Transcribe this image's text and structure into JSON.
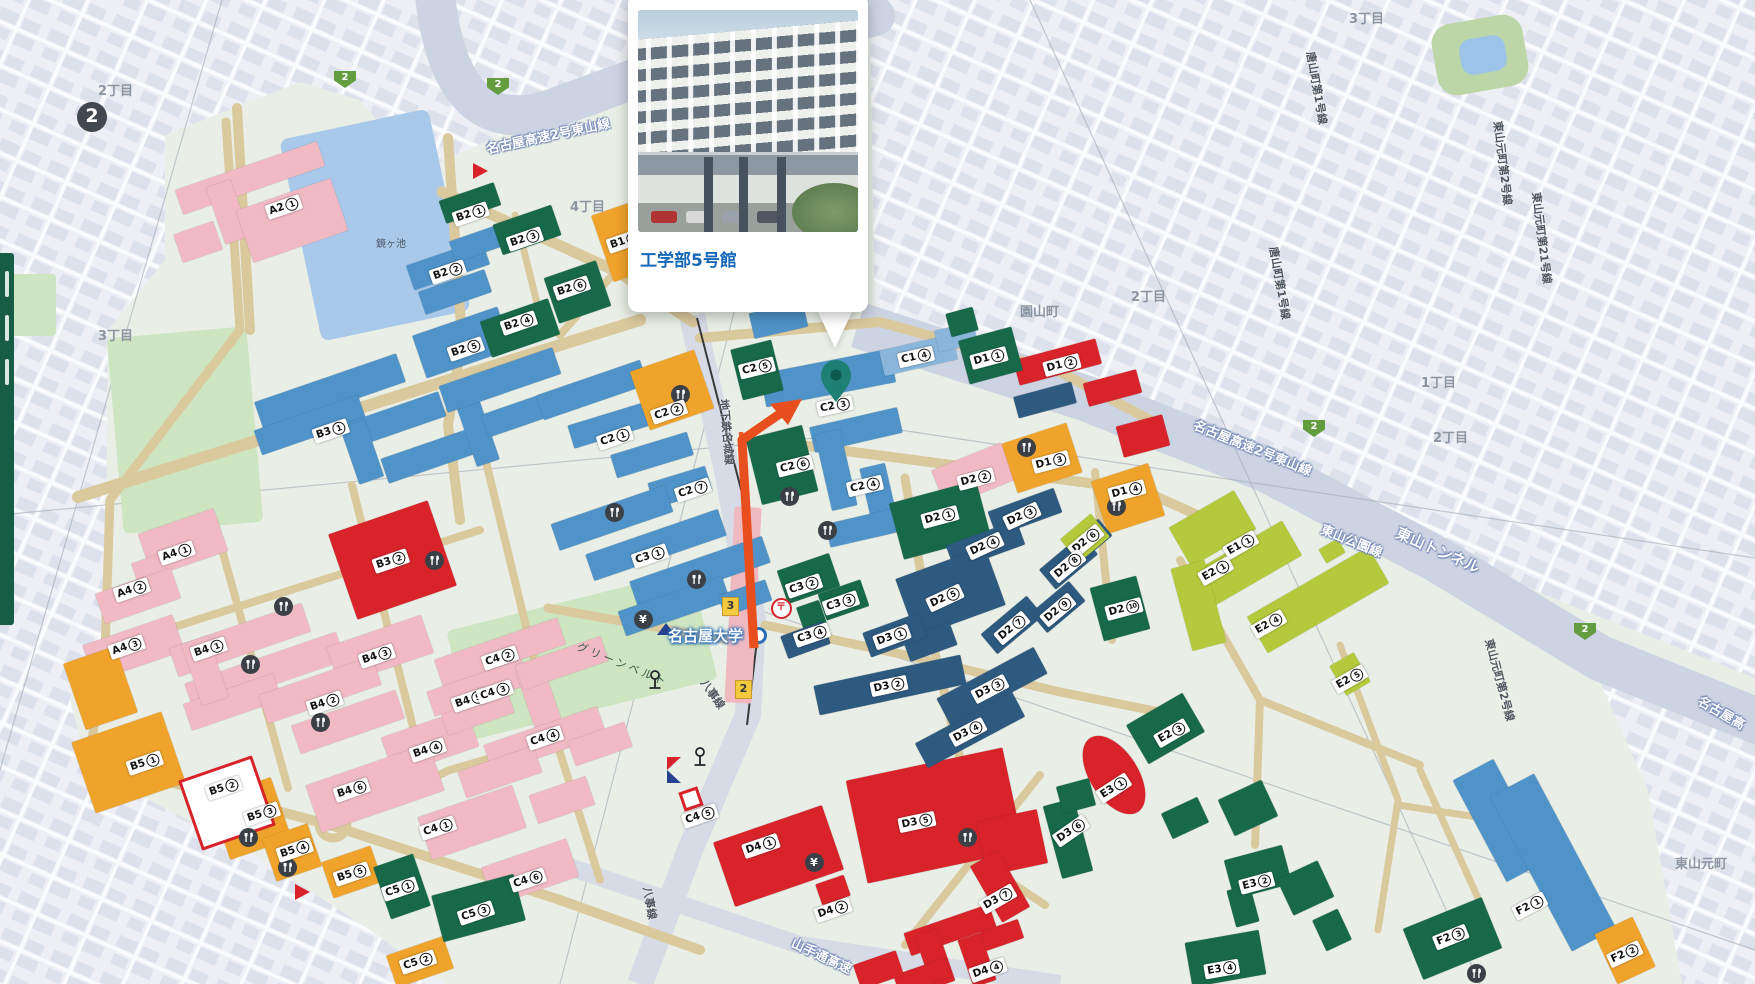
{
  "popup": {
    "title": "工学部5号館"
  },
  "colors": {
    "campus": "#e9efe6",
    "offcampus": "#edeff4",
    "offblock": "#dde1ec",
    "road_campus": "#dbc99e",
    "highway": "#ccd3e2",
    "pond": "#a9c9ea",
    "field": "#cde5c0",
    "blue": "#4f93c8",
    "lightblue": "#8ab6dc",
    "pink": "#f0b9c4",
    "red": "#d8232b",
    "orange": "#f0a32a",
    "green": "#17694a",
    "navy": "#2e5a80",
    "lime": "#b5c93c",
    "pin": "#1e7f74",
    "pin_dark": "#0c584f",
    "arrow": "#e84e1e",
    "title_blue": "#1668b8",
    "subway_orange": "#f15c2c",
    "station_pink": "#f0b9c0"
  },
  "map": {
    "station": {
      "name": "名古屋大学"
    },
    "building_labels": [
      {
        "t": "A2",
        "n": "1",
        "x": 284,
        "y": 207
      },
      {
        "t": "A4",
        "n": "1",
        "x": 177,
        "y": 553
      },
      {
        "t": "A4",
        "n": "2",
        "x": 132,
        "y": 590
      },
      {
        "t": "A4",
        "n": "3",
        "x": 127,
        "y": 647
      },
      {
        "t": "B1",
        "n": "1",
        "x": 625,
        "y": 241
      },
      {
        "t": "B2",
        "n": "1",
        "x": 471,
        "y": 214
      },
      {
        "t": "B2",
        "n": "2",
        "x": 448,
        "y": 272
      },
      {
        "t": "B2",
        "n": "3",
        "x": 525,
        "y": 239
      },
      {
        "t": "B2",
        "n": "4",
        "x": 519,
        "y": 323
      },
      {
        "t": "B2",
        "n": "5",
        "x": 466,
        "y": 349
      },
      {
        "t": "B2",
        "n": "6",
        "x": 572,
        "y": 288
      },
      {
        "t": "B3",
        "n": "1",
        "x": 331,
        "y": 431
      },
      {
        "t": "B3",
        "n": "2",
        "x": 391,
        "y": 561
      },
      {
        "t": "B4",
        "n": "1",
        "x": 209,
        "y": 649
      },
      {
        "t": "B4",
        "n": "2",
        "x": 325,
        "y": 703
      },
      {
        "t": "B4",
        "n": "3",
        "x": 377,
        "y": 656
      },
      {
        "t": "B4",
        "n": "4",
        "x": 428,
        "y": 750
      },
      {
        "t": "B4",
        "n": "5",
        "x": 470,
        "y": 700
      },
      {
        "t": "B4",
        "n": "6",
        "x": 352,
        "y": 790
      },
      {
        "t": "B5",
        "n": "1",
        "x": 145,
        "y": 763
      },
      {
        "t": "B5",
        "n": "2",
        "x": 224,
        "y": 788
      },
      {
        "t": "B5",
        "n": "3",
        "x": 262,
        "y": 814
      },
      {
        "t": "B5",
        "n": "4",
        "x": 295,
        "y": 850
      },
      {
        "t": "B5",
        "n": "5",
        "x": 352,
        "y": 874
      },
      {
        "t": "C1",
        "n": "4",
        "x": 916,
        "y": 357,
        "r": -13
      },
      {
        "t": "C2",
        "n": "1",
        "x": 615,
        "y": 438
      },
      {
        "t": "C2",
        "n": "2",
        "x": 669,
        "y": 412
      },
      {
        "t": "C2",
        "n": "3",
        "x": 835,
        "y": 406,
        "r": -12
      },
      {
        "t": "C2",
        "n": "4",
        "x": 865,
        "y": 486,
        "r": -13
      },
      {
        "t": "C2",
        "n": "5",
        "x": 757,
        "y": 368,
        "r": -14
      },
      {
        "t": "C2",
        "n": "6",
        "x": 795,
        "y": 466,
        "r": -14
      },
      {
        "t": "C2",
        "n": "7",
        "x": 693,
        "y": 490
      },
      {
        "t": "C3",
        "n": "1",
        "x": 650,
        "y": 556
      },
      {
        "t": "C3",
        "n": "2",
        "x": 804,
        "y": 586
      },
      {
        "t": "C3",
        "n": "3",
        "x": 841,
        "y": 603
      },
      {
        "t": "C3",
        "n": "4",
        "x": 812,
        "y": 635
      },
      {
        "t": "C4",
        "n": "1",
        "x": 438,
        "y": 828
      },
      {
        "t": "C4",
        "n": "2",
        "x": 500,
        "y": 658
      },
      {
        "t": "C4",
        "n": "3",
        "x": 495,
        "y": 692
      },
      {
        "t": "C4",
        "n": "4",
        "x": 545,
        "y": 738
      },
      {
        "t": "C4",
        "n": "5",
        "x": 700,
        "y": 816
      },
      {
        "t": "C4",
        "n": "6",
        "x": 528,
        "y": 880
      },
      {
        "t": "C5",
        "n": "1",
        "x": 400,
        "y": 889
      },
      {
        "t": "C5",
        "n": "2",
        "x": 418,
        "y": 962
      },
      {
        "t": "C5",
        "n": "3",
        "x": 476,
        "y": 913
      },
      {
        "t": "D1",
        "n": "1",
        "x": 989,
        "y": 358,
        "r": -15
      },
      {
        "t": "D1",
        "n": "2",
        "x": 1062,
        "y": 365,
        "r": -15
      },
      {
        "t": "D1",
        "n": "3",
        "x": 1051,
        "y": 462,
        "r": -15
      },
      {
        "t": "D1",
        "n": "4",
        "x": 1127,
        "y": 491,
        "r": -15
      },
      {
        "t": "D2",
        "n": "1",
        "x": 940,
        "y": 517,
        "r": -15
      },
      {
        "t": "D2",
        "n": "2",
        "x": 976,
        "y": 479,
        "r": -15
      },
      {
        "t": "D2",
        "n": "3",
        "x": 1022,
        "y": 516,
        "r": -25
      },
      {
        "t": "D2",
        "n": "4",
        "x": 985,
        "y": 546,
        "r": -25
      },
      {
        "t": "D2",
        "n": "5",
        "x": 945,
        "y": 598,
        "r": -25
      },
      {
        "t": "D2",
        "n": "6",
        "x": 1086,
        "y": 541,
        "r": -40
      },
      {
        "t": "D2",
        "n": "7",
        "x": 1012,
        "y": 628,
        "r": -40
      },
      {
        "t": "D2",
        "n": "8",
        "x": 1068,
        "y": 566,
        "r": -40
      },
      {
        "t": "D2",
        "n": "9",
        "x": 1058,
        "y": 610,
        "r": -40
      },
      {
        "t": "D2",
        "n": "10",
        "x": 1124,
        "y": 609,
        "r": -15
      },
      {
        "t": "D3",
        "n": "1",
        "x": 892,
        "y": 637,
        "r": -20
      },
      {
        "t": "D3",
        "n": "2",
        "x": 889,
        "y": 686,
        "r": -12
      },
      {
        "t": "D3",
        "n": "3",
        "x": 990,
        "y": 689,
        "r": -28
      },
      {
        "t": "D3",
        "n": "4",
        "x": 968,
        "y": 732,
        "r": -28
      },
      {
        "t": "D3",
        "n": "5",
        "x": 917,
        "y": 822,
        "r": -12
      },
      {
        "t": "D3",
        "n": "6",
        "x": 1071,
        "y": 831,
        "r": -35
      },
      {
        "t": "D3",
        "n": "7",
        "x": 998,
        "y": 899,
        "r": -30
      },
      {
        "t": "D4",
        "n": "1",
        "x": 761,
        "y": 846
      },
      {
        "t": "D4",
        "n": "2",
        "x": 833,
        "y": 910
      },
      {
        "t": "D4",
        "n": "4",
        "x": 988,
        "y": 970
      },
      {
        "t": "E1",
        "n": "1",
        "x": 1241,
        "y": 545,
        "r": -30
      },
      {
        "t": "E2",
        "n": "1",
        "x": 1216,
        "y": 571,
        "r": -30
      },
      {
        "t": "E2",
        "n": "3",
        "x": 1172,
        "y": 733,
        "r": -30
      },
      {
        "t": "E2",
        "n": "4",
        "x": 1269,
        "y": 624,
        "r": -30
      },
      {
        "t": "E2",
        "n": "5",
        "x": 1350,
        "y": 679,
        "r": -30
      },
      {
        "t": "E3",
        "n": "1",
        "x": 1114,
        "y": 788,
        "r": -33
      },
      {
        "t": "E3",
        "n": "2",
        "x": 1257,
        "y": 883,
        "r": -15
      },
      {
        "t": "E3",
        "n": "4",
        "x": 1222,
        "y": 969,
        "r": -10
      },
      {
        "t": "F2",
        "n": "1",
        "x": 1530,
        "y": 906,
        "r": -28
      },
      {
        "t": "F2",
        "n": "2",
        "x": 1625,
        "y": 954,
        "r": -25
      },
      {
        "t": "F2",
        "n": "3",
        "x": 1451,
        "y": 937,
        "r": -22
      }
    ],
    "area_labels": [
      {
        "t": "2丁目",
        "x": 98,
        "y": 80
      },
      {
        "t": "3丁目",
        "x": 98,
        "y": 325
      },
      {
        "t": "4丁目",
        "x": 570,
        "y": 196
      },
      {
        "t": "園山町",
        "x": 1020,
        "y": 301
      },
      {
        "t": "2丁目",
        "x": 1131,
        "y": 286
      },
      {
        "t": "3丁目",
        "x": 1349,
        "y": 8
      },
      {
        "t": "1丁目",
        "x": 1421,
        "y": 372
      },
      {
        "t": "2丁目",
        "x": 1433,
        "y": 427
      },
      {
        "t": "東山元町",
        "x": 1675,
        "y": 853
      },
      {
        "t": "鏡ヶ池",
        "x": 376,
        "y": 235,
        "cls": "small"
      },
      {
        "t": "グリーンベルト",
        "x": 574,
        "y": 656,
        "r": 22,
        "cls": "parklab"
      }
    ],
    "road_labels": [
      {
        "t": "名古屋高速2号東山線",
        "x": 548,
        "y": 135,
        "r": -12,
        "cls": "rl-hw"
      },
      {
        "t": "名古屋高速2号東山線",
        "x": 1253,
        "y": 447,
        "r": 22,
        "cls": "rl-hw"
      },
      {
        "t": "東山公園線",
        "x": 1352,
        "y": 540,
        "r": 22,
        "cls": "rl-hw"
      },
      {
        "t": "東山トンネル",
        "x": 1438,
        "y": 550,
        "r": 24,
        "cls": "rl-hw big"
      },
      {
        "t": "名古屋高",
        "x": 1722,
        "y": 712,
        "r": 30,
        "cls": "rl-hw"
      },
      {
        "t": "唐山町第1号線",
        "x": 1317,
        "y": 88,
        "r": 80,
        "cls": "rl-dark"
      },
      {
        "t": "唐山町第1号線",
        "x": 1280,
        "y": 283,
        "r": 80,
        "cls": "rl-dark"
      },
      {
        "t": "東山元町第2号線",
        "x": 1503,
        "y": 163,
        "r": 83,
        "cls": "rl-dark"
      },
      {
        "t": "東山元町第21号線",
        "x": 1542,
        "y": 238,
        "r": 83,
        "cls": "rl-dark"
      },
      {
        "t": "東山元町第2号線",
        "x": 1500,
        "y": 680,
        "r": 75,
        "cls": "rl-dark"
      },
      {
        "t": "地下鉄名城線",
        "x": 727,
        "y": 432,
        "r": 85,
        "cls": "rl-dark"
      },
      {
        "t": "八事線",
        "x": 713,
        "y": 694,
        "r": 55,
        "cls": "rl-dark"
      },
      {
        "t": "八事線",
        "x": 650,
        "y": 903,
        "r": 80,
        "cls": "rl-dark"
      },
      {
        "t": "山手通高速",
        "x": 822,
        "y": 955,
        "r": 25,
        "cls": "rl-hw"
      }
    ],
    "route_badges": [
      {
        "t": "2",
        "x": 345,
        "y": 79
      },
      {
        "t": "2",
        "x": 498,
        "y": 86
      },
      {
        "t": "2",
        "x": 1314,
        "y": 428
      },
      {
        "t": "2",
        "x": 1585,
        "y": 631
      }
    ],
    "exits": [
      {
        "t": "3",
        "x": 729,
        "y": 605
      },
      {
        "t": "2",
        "x": 742,
        "y": 688
      }
    ],
    "subway_marker": {
      "t": "2",
      "x": 92,
      "y": 117
    },
    "poi": [
      {
        "k": "restaurant",
        "x": 680,
        "y": 394
      },
      {
        "k": "restaurant",
        "x": 614,
        "y": 512
      },
      {
        "k": "restaurant",
        "x": 696,
        "y": 579
      },
      {
        "k": "restaurant",
        "x": 789,
        "y": 496
      },
      {
        "k": "restaurant",
        "x": 827,
        "y": 530
      },
      {
        "k": "restaurant",
        "x": 434,
        "y": 560
      },
      {
        "k": "restaurant",
        "x": 283,
        "y": 606
      },
      {
        "k": "restaurant",
        "x": 250,
        "y": 664
      },
      {
        "k": "restaurant",
        "x": 320,
        "y": 722
      },
      {
        "k": "restaurant",
        "x": 248,
        "y": 837
      },
      {
        "k": "restaurant",
        "x": 287,
        "y": 867
      },
      {
        "k": "restaurant",
        "x": 967,
        "y": 837
      },
      {
        "k": "restaurant",
        "x": 1026,
        "y": 447
      },
      {
        "k": "restaurant",
        "x": 1116,
        "y": 506
      },
      {
        "k": "restaurant",
        "x": 1476,
        "y": 973
      },
      {
        "k": "atm",
        "x": 643,
        "y": 619
      },
      {
        "k": "atm",
        "x": 814,
        "y": 862
      },
      {
        "k": "post",
        "x": 780,
        "y": 607
      },
      {
        "k": "monument",
        "x": 655,
        "y": 681
      },
      {
        "k": "monument",
        "x": 700,
        "y": 758
      }
    ],
    "markers": [
      {
        "k": "tri-red",
        "x": 480,
        "y": 171
      },
      {
        "k": "tri-red",
        "x": 302,
        "y": 892
      },
      {
        "k": "tri-blue",
        "x": 666,
        "y": 628
      },
      {
        "k": "flag",
        "x": 674,
        "y": 770
      },
      {
        "k": "redsq",
        "x": 691,
        "y": 799
      }
    ],
    "pin": {
      "x": 836,
      "y": 402
    }
  }
}
